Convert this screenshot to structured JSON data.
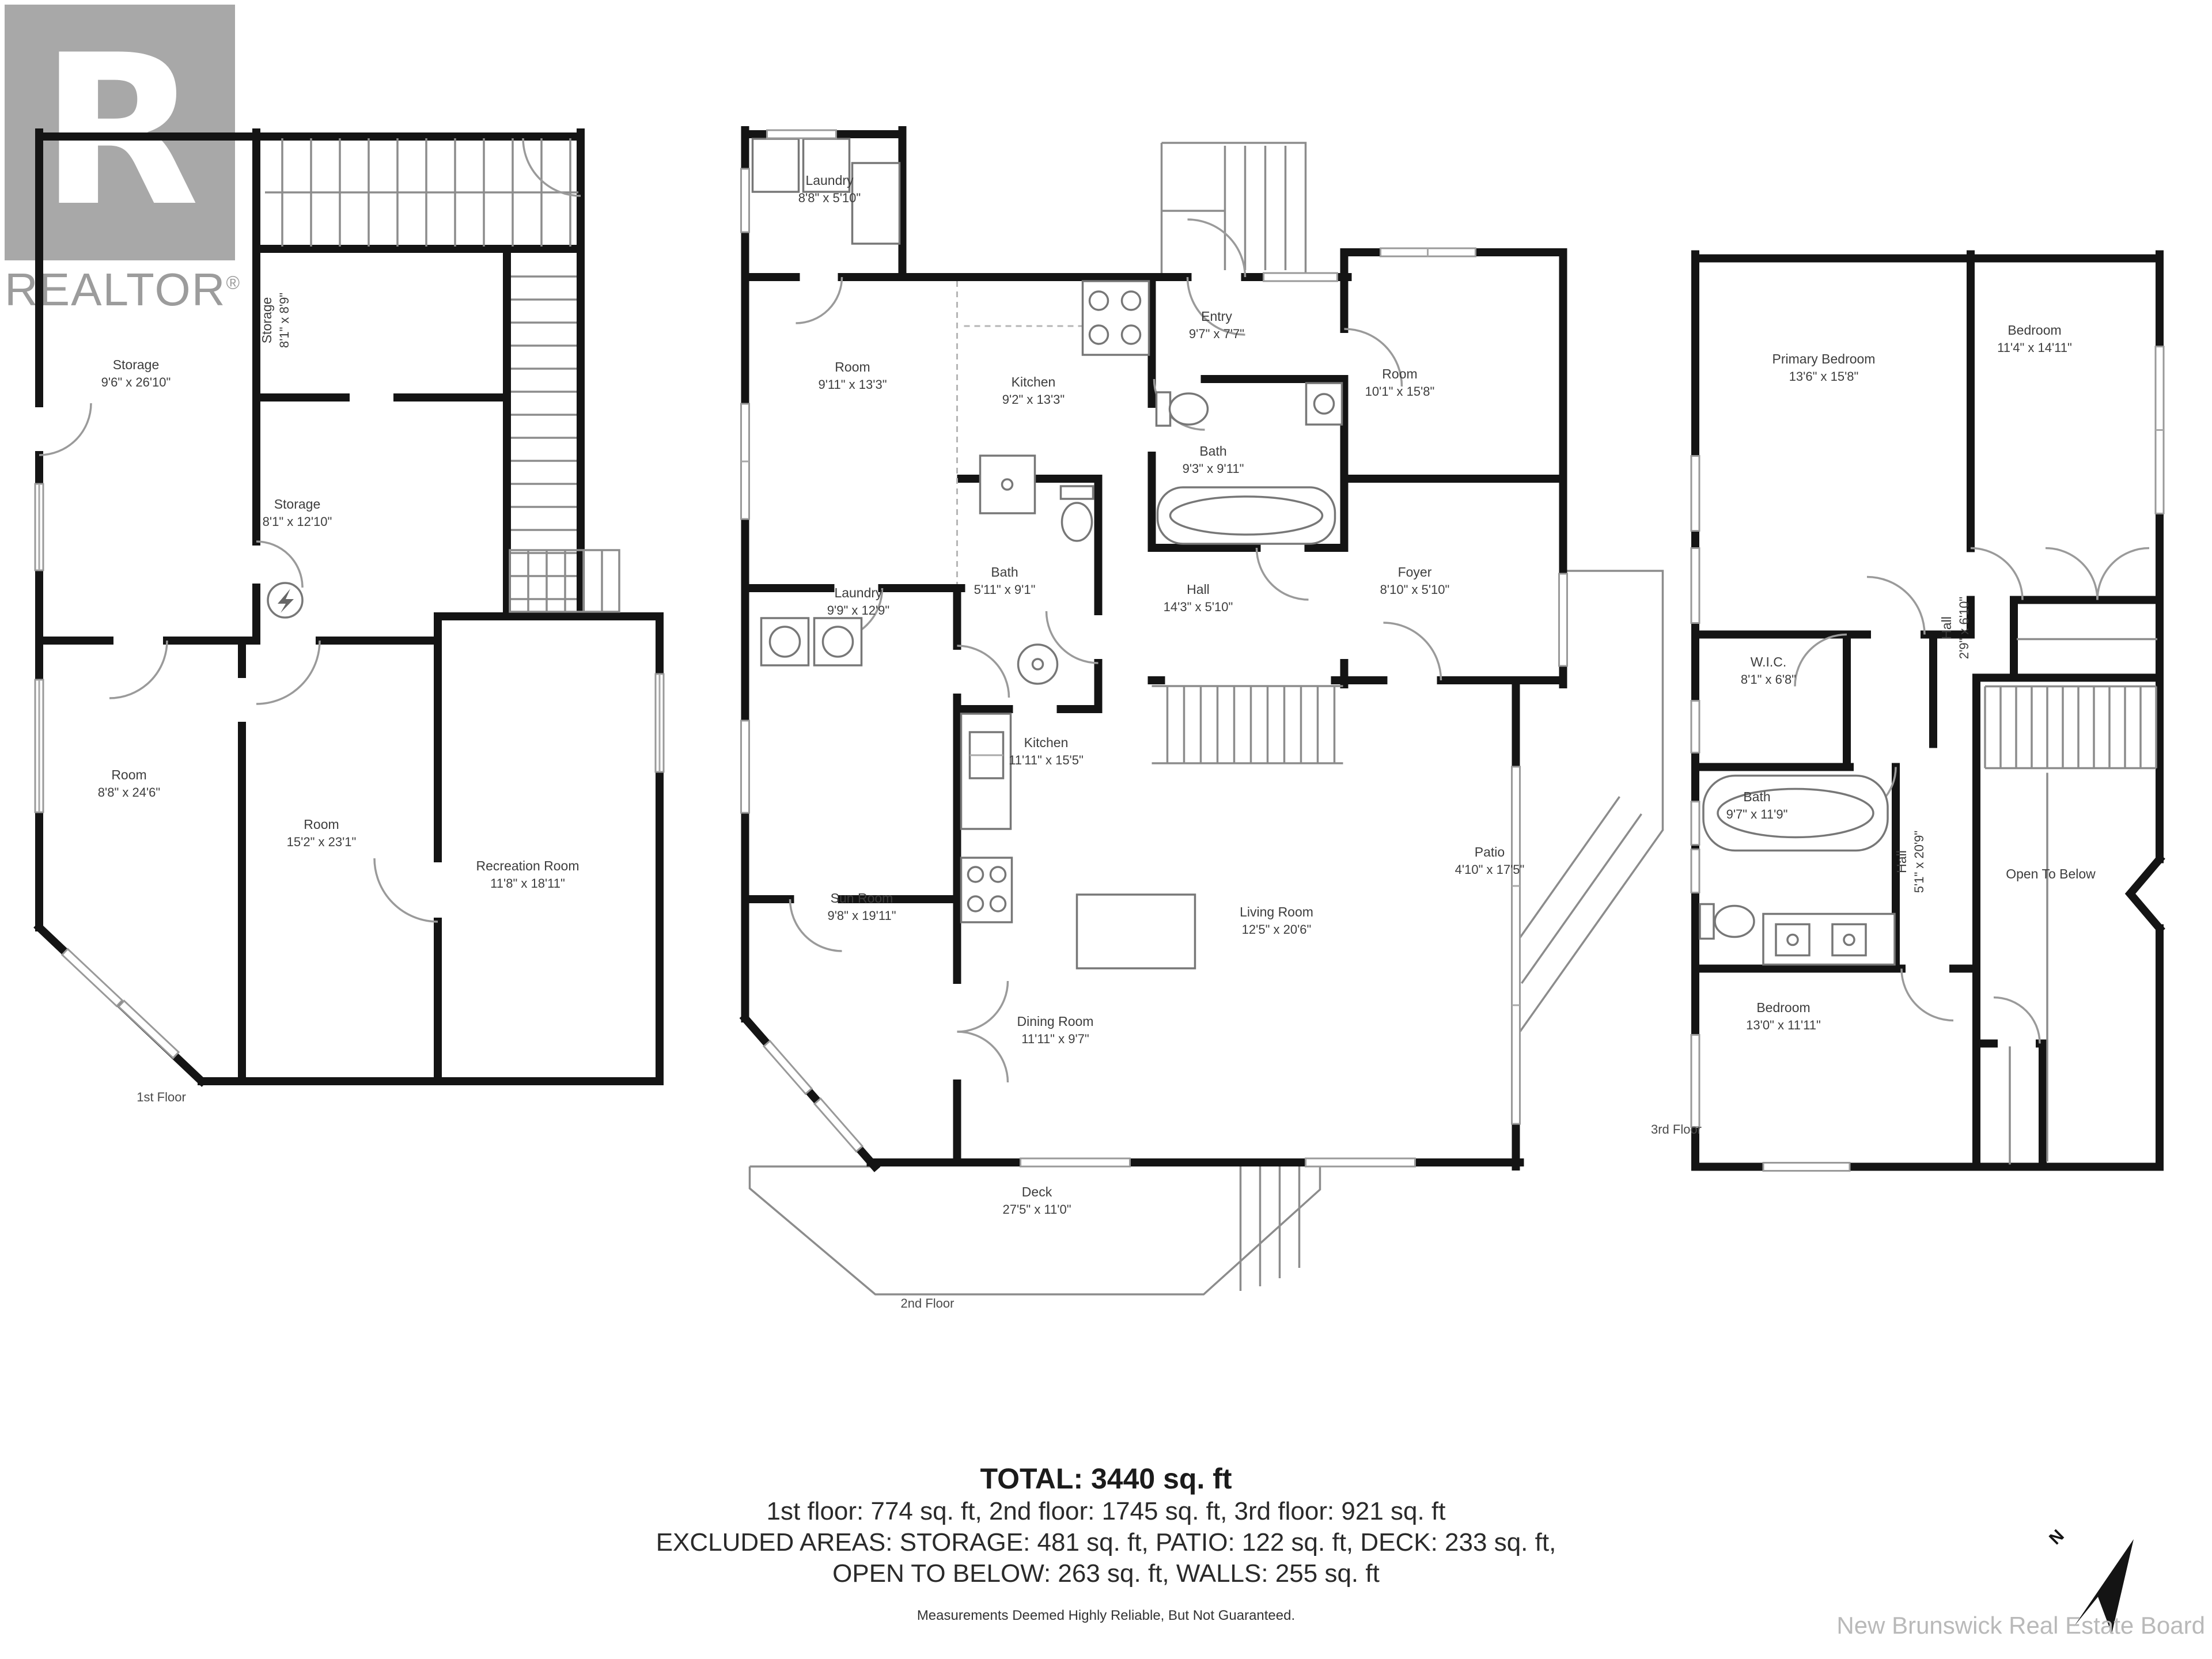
{
  "branding": {
    "logo_letter": "R",
    "logo_word": "REALTOR",
    "registered_mark": "®",
    "board_credit": "New Brunswick Real Estate Board",
    "north_label": "N"
  },
  "floors": [
    {
      "label": "1st Floor",
      "rooms": [
        {
          "name": "Storage",
          "dims": "9'6\" x 26'10\""
        },
        {
          "name": "Storage",
          "dims": "8'1\" x 8'9\""
        },
        {
          "name": "Storage",
          "dims": "8'1\" x 12'10\""
        },
        {
          "name": "Room",
          "dims": "8'8\" x 24'6\""
        },
        {
          "name": "Room",
          "dims": "15'2\" x 23'1\""
        },
        {
          "name": "Recreation Room",
          "dims": "11'8\" x 18'11\""
        }
      ]
    },
    {
      "label": "2nd Floor",
      "rooms": [
        {
          "name": "Laundry",
          "dims": "8'8\" x 5'10\""
        },
        {
          "name": "Room",
          "dims": "9'11\" x 13'3\""
        },
        {
          "name": "Kitchen",
          "dims": "9'2\" x 13'3\""
        },
        {
          "name": "Entry",
          "dims": "9'7\" x 7'7\""
        },
        {
          "name": "Room",
          "dims": "10'1\" x 15'8\""
        },
        {
          "name": "Bath",
          "dims": "9'3\" x 9'11\""
        },
        {
          "name": "Bath",
          "dims": "5'11\" x 9'1\""
        },
        {
          "name": "Laundry",
          "dims": "9'9\" x 12'9\""
        },
        {
          "name": "Hall",
          "dims": "14'3\" x 5'10\""
        },
        {
          "name": "Foyer",
          "dims": "8'10\" x 5'10\""
        },
        {
          "name": "Kitchen",
          "dims": "11'11\" x 15'5\""
        },
        {
          "name": "Sun Room",
          "dims": "9'8\" x 19'11\""
        },
        {
          "name": "Dining Room",
          "dims": "11'11\" x 9'7\""
        },
        {
          "name": "Living Room",
          "dims": "12'5\" x 20'6\""
        },
        {
          "name": "Patio",
          "dims": "4'10\" x 17'5\""
        },
        {
          "name": "Deck",
          "dims": "27'5\" x 11'0\""
        }
      ]
    },
    {
      "label": "3rd Floor",
      "rooms": [
        {
          "name": "Primary Bedroom",
          "dims": "13'6\" x 15'8\""
        },
        {
          "name": "Bedroom",
          "dims": "11'4\" x 14'11\""
        },
        {
          "name": "W.I.C.",
          "dims": "8'1\" x 6'8\""
        },
        {
          "name": "Hall",
          "dims": "2'9\" x 6'10\""
        },
        {
          "name": "Bath",
          "dims": "9'7\" x 11'9\""
        },
        {
          "name": "Hall",
          "dims": "5'1\" x 20'9\""
        },
        {
          "name": "Open To Below",
          "dims": ""
        },
        {
          "name": "Bedroom",
          "dims": "13'0\" x 11'11\""
        }
      ]
    }
  ],
  "summary": {
    "total": "TOTAL: 3440 sq. ft",
    "floors_line": "1st floor: 774 sq. ft, 2nd floor: 1745 sq. ft, 3rd floor: 921 sq. ft",
    "excluded_line1": "EXCLUDED AREAS: STORAGE: 481 sq. ft, PATIO: 122 sq. ft, DECK: 233 sq. ft,",
    "excluded_line2": "OPEN TO BELOW: 263 sq. ft, WALLS: 255 sq. ft",
    "disclaimer": "Measurements Deemed Highly Reliable, But Not Guaranteed."
  }
}
